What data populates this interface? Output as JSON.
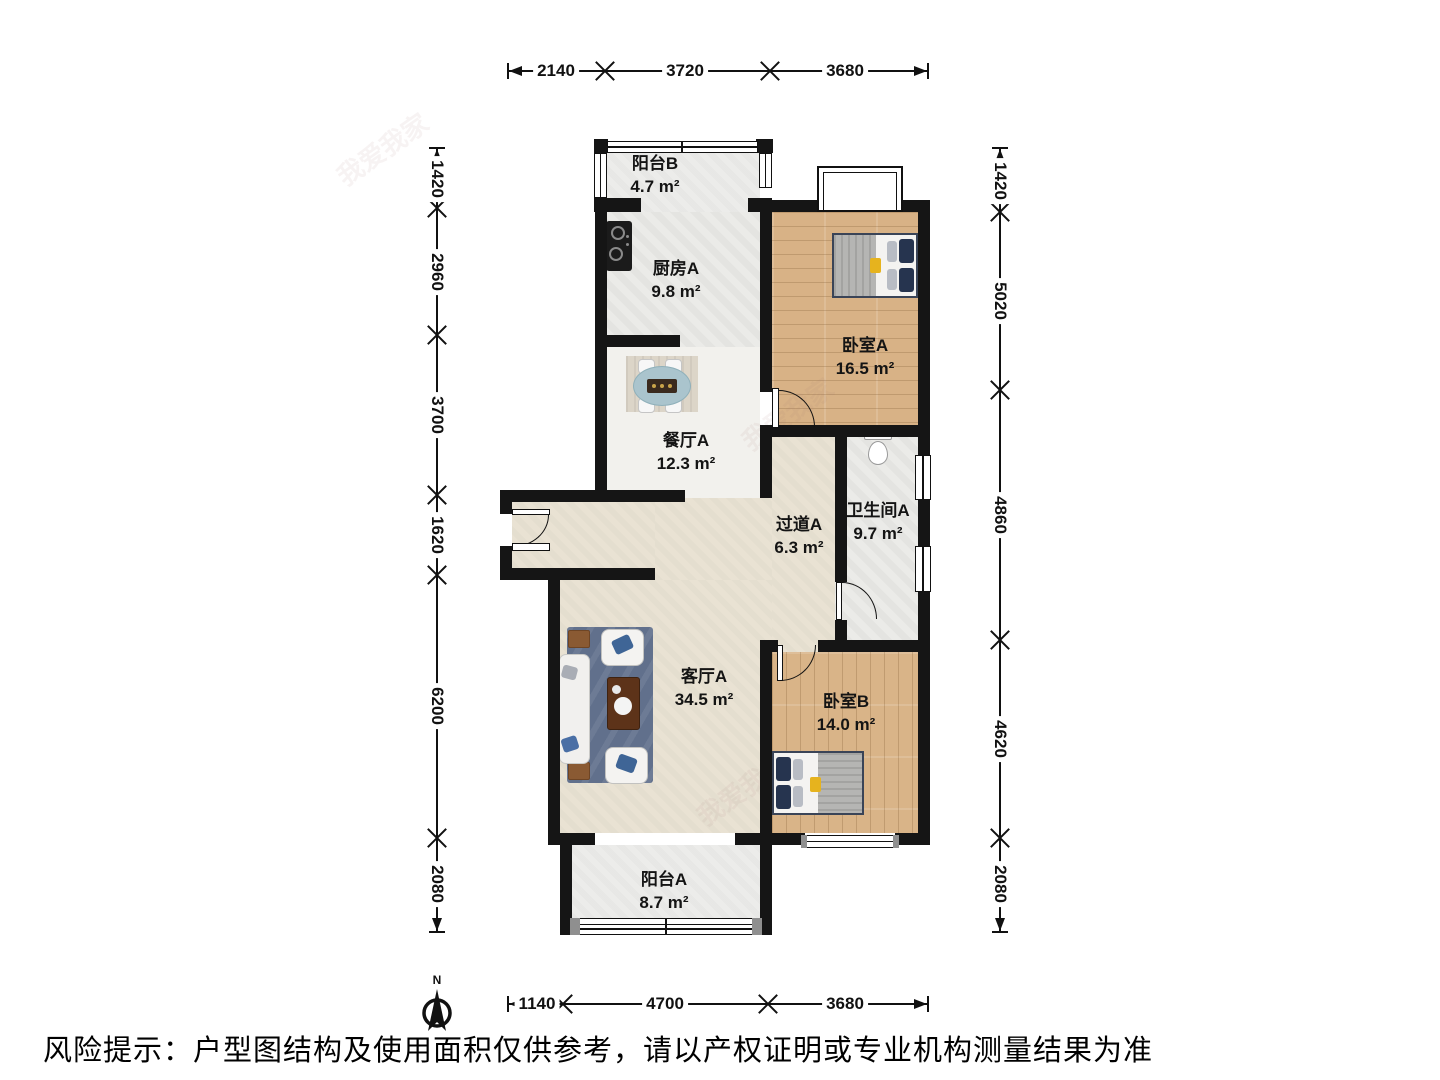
{
  "rooms": [
    {
      "name": "阳台B",
      "area": "4.7 m²"
    },
    {
      "name": "厨房A",
      "area": "9.8 m²"
    },
    {
      "name": "卧室A",
      "area": "16.5 m²"
    },
    {
      "name": "餐厅A",
      "area": "12.3 m²"
    },
    {
      "name": "过道A",
      "area": "6.3 m²"
    },
    {
      "name": "卫生间A",
      "area": "9.7 m²"
    },
    {
      "name": "客厅A",
      "area": "34.5 m²"
    },
    {
      "name": "卧室B",
      "area": "14.0 m²"
    },
    {
      "name": "阳台A",
      "area": "8.7 m²"
    }
  ],
  "dimensions": {
    "top": [
      "2140",
      "3720",
      "3680"
    ],
    "left": [
      "1420",
      "2960",
      "3700",
      "1620",
      "6200",
      "2080"
    ],
    "right": [
      "1420",
      "5020",
      "4860",
      "4620",
      "2080"
    ],
    "bottom": [
      "1140",
      "4700",
      "3680"
    ]
  },
  "compass": {
    "north_label": "N"
  },
  "footer": {
    "risk_text": "风险提示：户型图结构及使用面积仅供参考，请以产权证明或专业机构测量结果为准"
  },
  "watermarks": {
    "brand": "我爱我家",
    "portal": "58同城"
  },
  "colors": {
    "wall": "#151515",
    "wood_floor": "#d8b286",
    "tile_floor": "#ebebe8",
    "warm_floor": "#e9e2d3",
    "accent_navy": "#26344f",
    "accent_yellow": "#e6b31e"
  }
}
